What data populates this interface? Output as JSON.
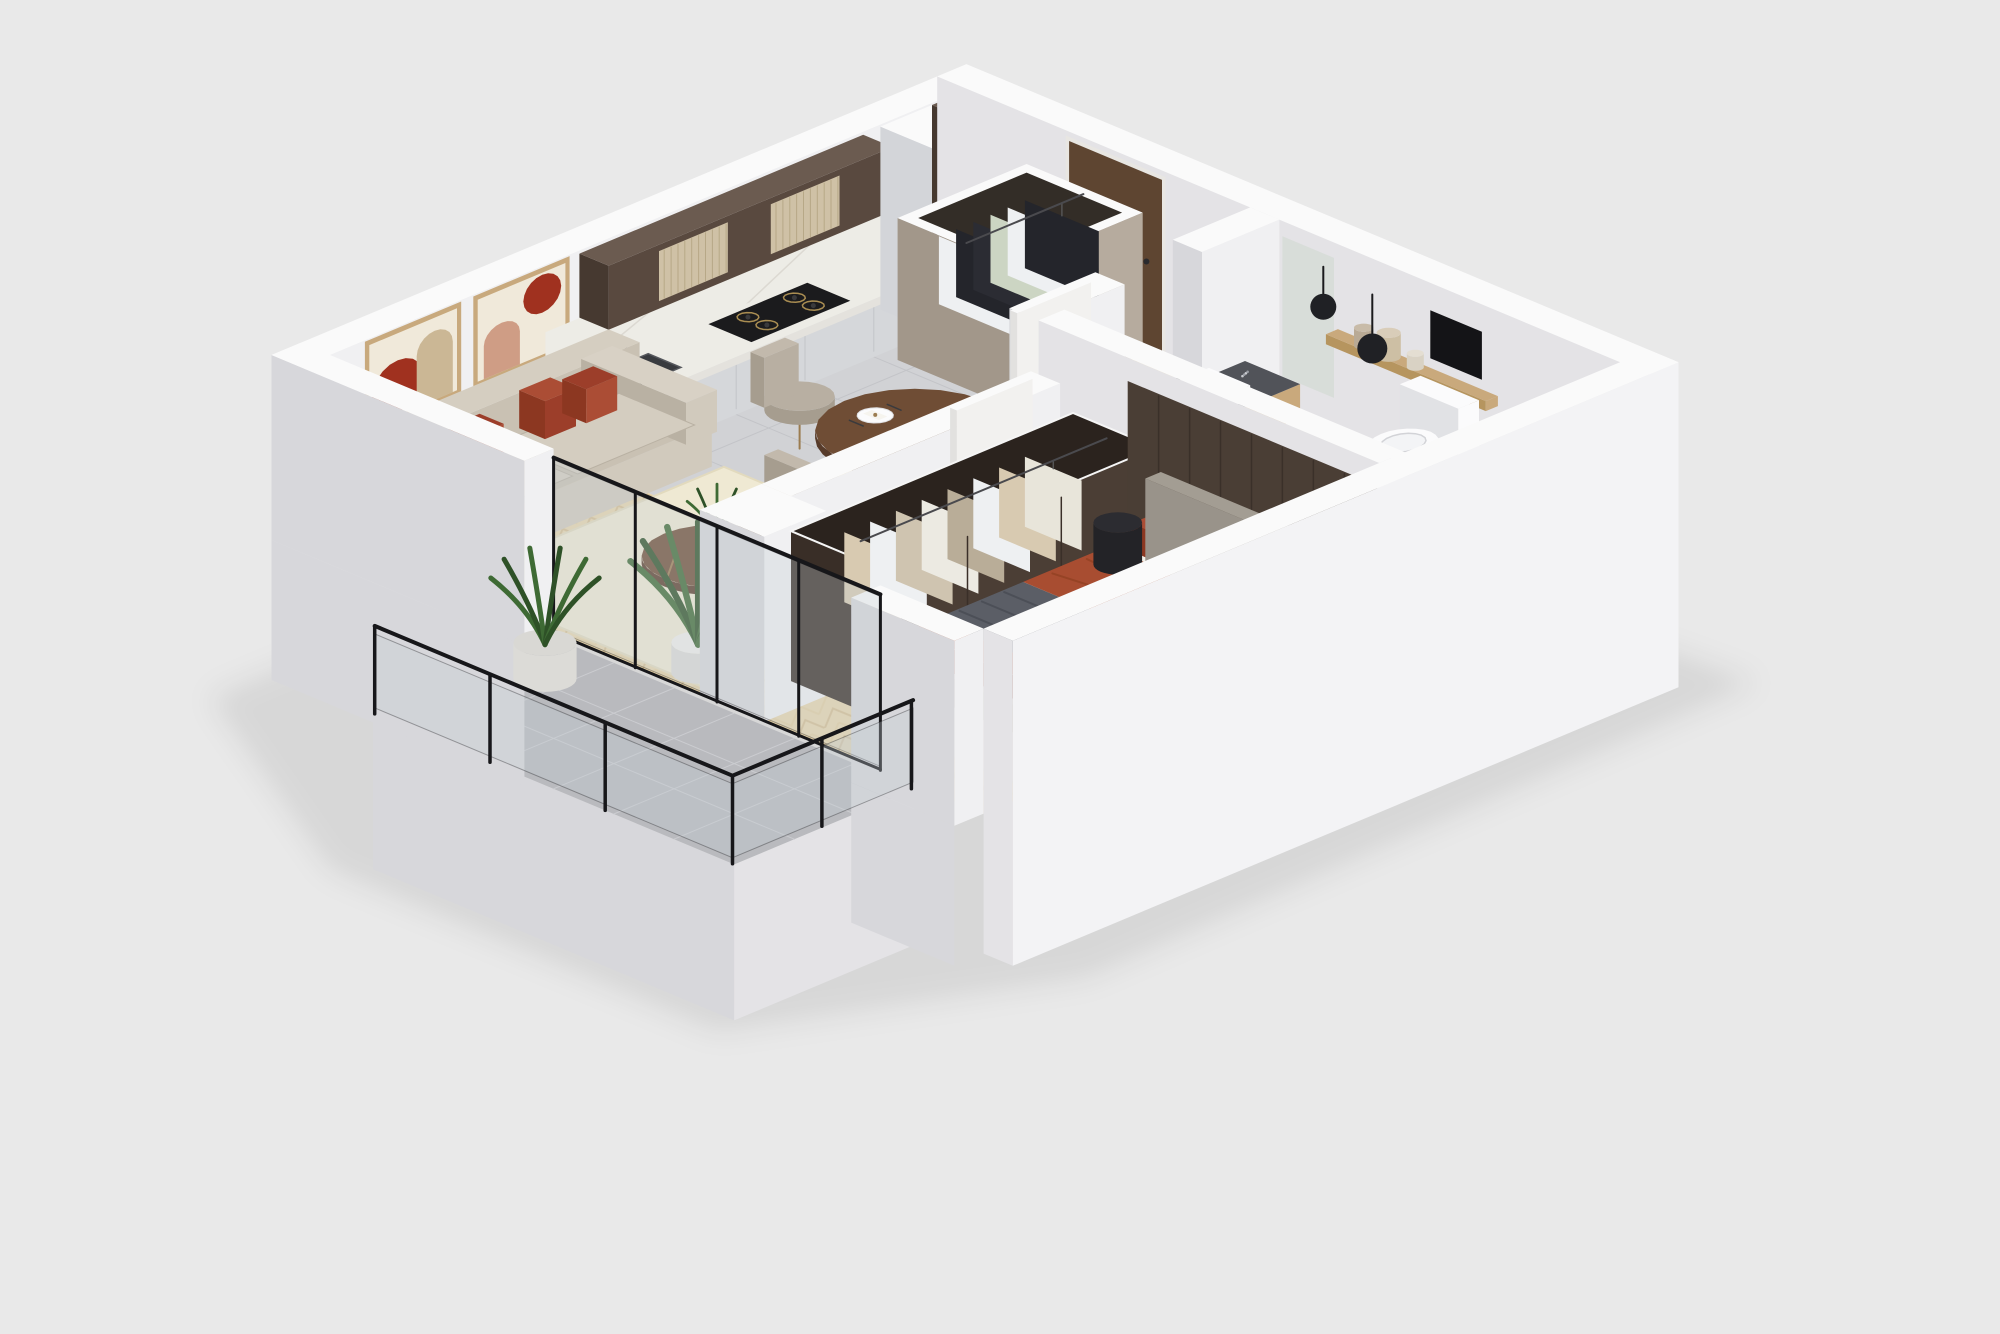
{
  "scene": {
    "description": "isometric-3d-apartment-floor-plan-render",
    "background_color": "#e9e9e9",
    "rooms": [
      {
        "id": "living-room",
        "furniture": [
          "sofa",
          "accent-pillows",
          "wall-art-diptych",
          "coffee-table",
          "side-table",
          "ottoman",
          "area-rug",
          "potted-plant"
        ]
      },
      {
        "id": "kitchen",
        "furniture": [
          "upper-cabinets",
          "base-cabinets",
          "marble-countertop",
          "sink",
          "gas-hob",
          "built-in-oven",
          "tall-cabinet"
        ]
      },
      {
        "id": "dining-area",
        "furniture": [
          "round-dining-table",
          "dining-chairs",
          "place-settings"
        ]
      },
      {
        "id": "entry-hall",
        "furniture": [
          "open-wardrobe",
          "hanging-clothes",
          "entry-door"
        ]
      },
      {
        "id": "bathroom",
        "furniture": [
          "vanity-sink",
          "wall-hung-toilet",
          "bathtub",
          "wall-shelf",
          "vases",
          "pendant-lamps",
          "mirror"
        ]
      },
      {
        "id": "bedroom",
        "furniture": [
          "double-bed",
          "headboard",
          "open-wardrobe",
          "nightstand",
          "bedroom-rug",
          "wood-panel-wall"
        ]
      },
      {
        "id": "balcony",
        "furniture": [
          "glass-balustrade",
          "planter-pot",
          "tiled-floor"
        ]
      }
    ],
    "counts": {
      "dining_chairs": 4,
      "place_settings": 4,
      "hob_burners": 4,
      "wall_art": 2,
      "sofa_accent_pillows": 4,
      "pendant_lamps": 2,
      "plants": 2,
      "entry_wardrobe_garments": 6,
      "bedroom_wardrobe_garments": 8
    }
  },
  "colors": {
    "bg": "#e9e9e9",
    "wallTop": "#fafafa",
    "wallLight": "#f0f0f2",
    "wallMid": "#e4e3e6",
    "wallShade": "#d7d7db",
    "wallDark": "#c9c9cf",
    "woodFloor": "#e8d6ae",
    "woodLine": "#d6bf93",
    "woodLineLight": "#e3cfa2",
    "kitchenTile": "#d1d2d5",
    "kitchenTileLine": "#c3c4c8",
    "bathTile": "#e6e5e2",
    "bathTileLine": "#d9d8d5",
    "balconyTile": "#b9babe",
    "balconyTileLine": "#cbccd0",
    "rugLiving": "#efe9d3",
    "rugLivingEdge": "#e2dabe",
    "rugBedroom": "#dcd8c9",
    "sofa": "#d1cabd",
    "sofaShade": "#b9b1a3",
    "sofaBack": "#c9c1b3",
    "sofaPad": "#d4cdc0",
    "sofaTop": "#d8d1c5",
    "pillowRust": "#9c3e2a",
    "pillowRustLight": "#ab4d35",
    "pillowRustDark": "#8c3721",
    "artFrame": "#c8a97d",
    "artCanvas": "#f0e9da",
    "artRed": "#a0311f",
    "artBeige": "#cbb795",
    "artPink": "#cf9d85",
    "cabinetDark": "#59493f",
    "cabinetDarker": "#463930",
    "cabinetTop": "#6b5b50",
    "ribbedPanel": "#cfc1a6",
    "ribLine": "#b7a887",
    "marble": "#edece6",
    "marbleSide": "#e4e2dd",
    "marbleVein": "#dcd9d2",
    "counterFace": "#d5d7da",
    "counterSide": "#c9cbcf",
    "counterSeam": "#c2c4c8",
    "sinkDark": "#393b3f",
    "sinkEdge": "#55575c",
    "steel": "#85888d",
    "hob": "#1b1b1d",
    "burnerRing": "#a98d52",
    "oven": "#202023",
    "ovenHandle": "#55565a",
    "ovenDisplay": "#3a3b41",
    "entryWardrobe": "#b6ab9e",
    "entryWardrobeShade": "#a2978a",
    "wardrobeInner": "#332d27",
    "clothWhite": "#eef0f2",
    "clothBlack": "#24252b",
    "clothSage": "#ccd5c3",
    "clothTan": "#d8cab1",
    "clothGray": "#b9ad98",
    "doorWood": "#5e4531",
    "doorWhite": "#f2f1ef",
    "doorShade": "#e2e1df",
    "tableWood": "#6f4d35",
    "tableWoodDark": "#573b2a",
    "chairSeat": "#b8afa2",
    "chairShade": "#a69d8f",
    "chairBackTop": "#c2b9ac",
    "brass": "#9b7c50",
    "espresso": "#4b3e35",
    "espressoShade": "#392e27",
    "espressoInner": "#2b231e",
    "panelSeam": "#3a3029",
    "headboard": "#99938a",
    "headboardSide": "#8f897f",
    "headboardTop": "#a39d93",
    "bedBase": "#cbc4b6",
    "bedBaseShade": "#b7afa1",
    "sheet": "#f2efe7",
    "sheetShade": "#eae6da",
    "mattressSide": "#e7e3d9",
    "blanketRust": "#a84d31",
    "blanketRustDark": "#8f3d25",
    "throwGray": "#5b5e66",
    "throwGrayDark": "#4c4f57",
    "pillowGray": "#b4b8be",
    "pillowGrayShade": "#9da1a8",
    "pillowGrayTop": "#c0c4ca",
    "black": "#1a1a1d",
    "porcelain": "#fbfbfc",
    "porcelainShade": "#e1e2e5",
    "porcelainDark": "#d2d3d7",
    "terrazzo": "#515359",
    "terrazzoDot": "#c9cbd0",
    "terrazzoDot2": "#9a9da4",
    "vanityWood": "#c9a97c",
    "vanityWoodShade": "#b6955f",
    "towel": "#c6c8cc",
    "towelShade": "#b0b2b6",
    "glass": "rgba(195,205,210,0.32)",
    "glassEdge": "#17171a",
    "plantGreen": "#3e6a34",
    "plantDark": "#2e5127",
    "pot": "#efeeeb",
    "potShade": "#dcdbd7",
    "potTop": "#d9d8d4",
    "mirror": "#d7dcd8",
    "niche": "#141417",
    "vase1": "#b9aa95",
    "vase2": "#cdbfa4",
    "vase3": "#d9d2c4",
    "shadow": "rgba(0,0,0,0.08)"
  }
}
